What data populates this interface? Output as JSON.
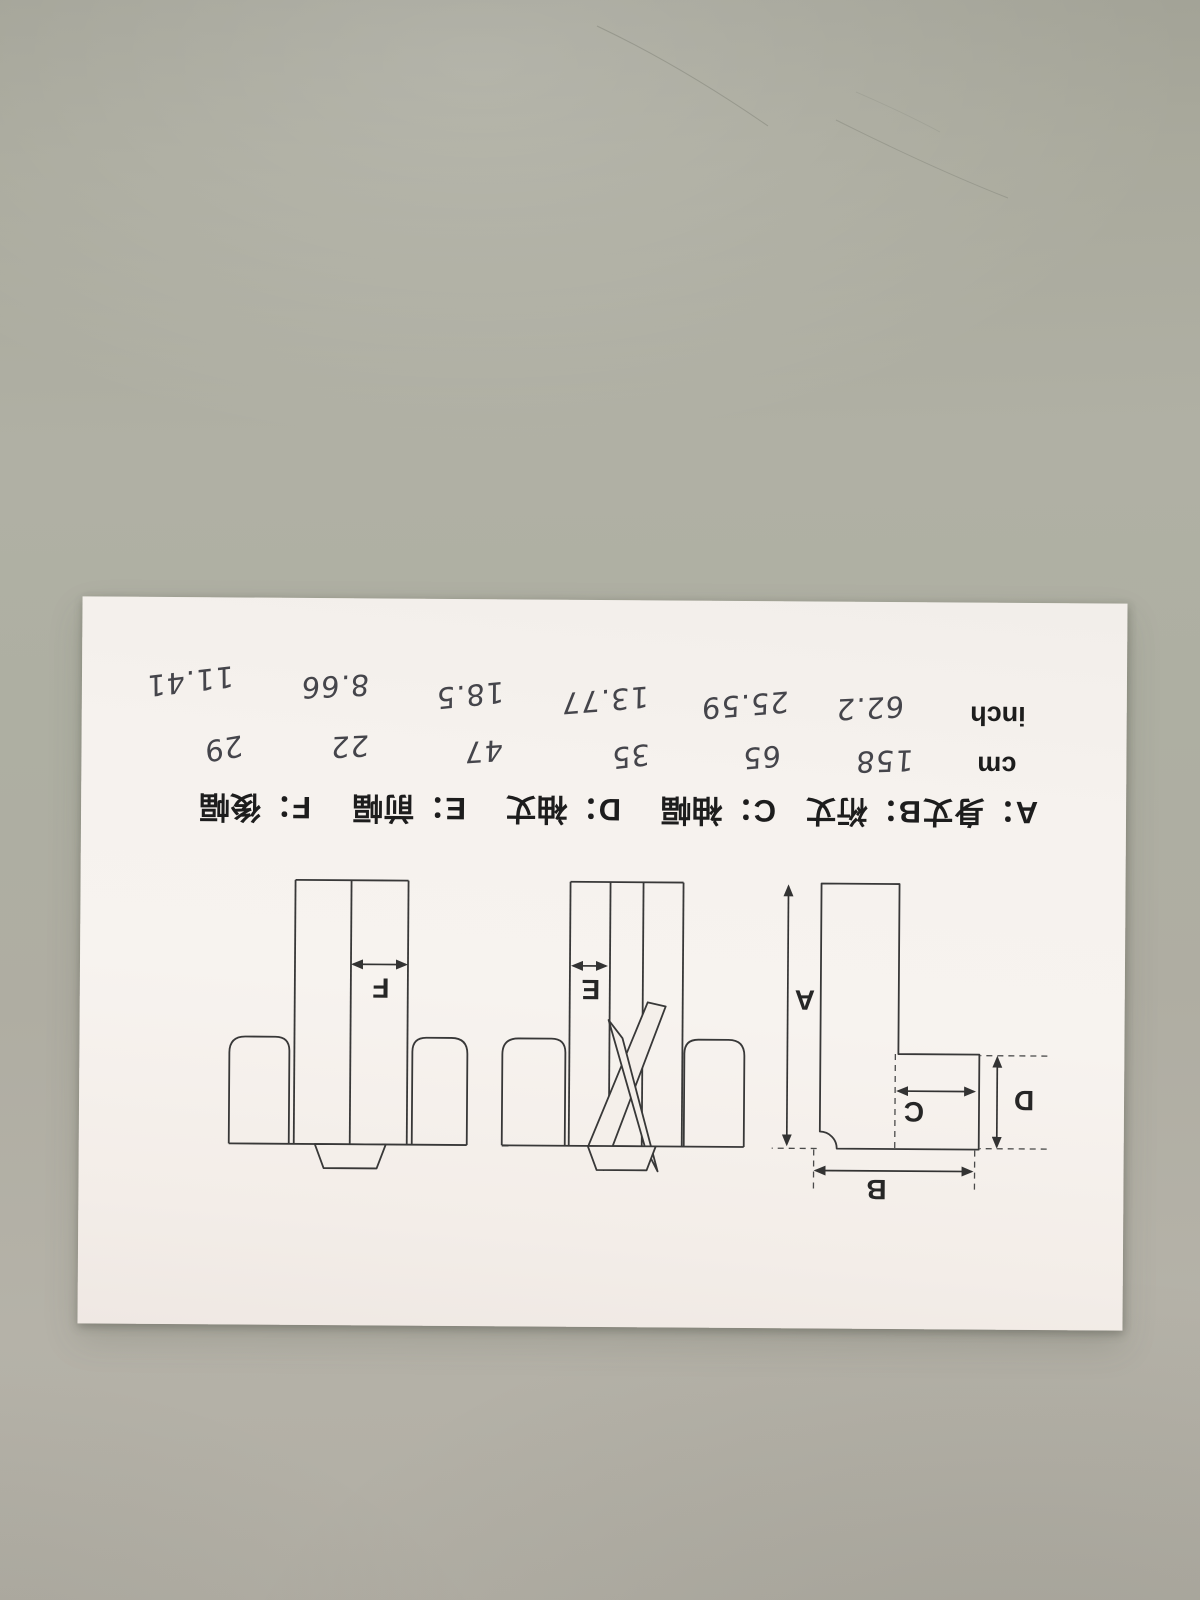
{
  "colors": {
    "desk": "#aeafa2",
    "paper": "#f4efea",
    "print_ink": "#1d1d1d",
    "handwriting_ink": "#45454b",
    "diagram_line": "#383838"
  },
  "doc": {
    "colon": "：",
    "units": {
      "cm": "cm",
      "inch": "inch"
    },
    "measurements": [
      {
        "letter": "A",
        "term": "身丈",
        "cm": "158",
        "inch": "62.2"
      },
      {
        "letter": "B",
        "term": "裄丈",
        "cm": "65",
        "inch": "25.59"
      },
      {
        "letter": "C",
        "term": "袖幅",
        "cm": "35",
        "inch": "13.77"
      },
      {
        "letter": "D",
        "term": "袖丈",
        "cm": "47",
        "inch": "18.5"
      },
      {
        "letter": "E",
        "term": "前幅",
        "cm": "22",
        "inch": "8.66"
      },
      {
        "letter": "F",
        "term": "後幅",
        "cm": "29",
        "inch": "11.41"
      }
    ]
  }
}
